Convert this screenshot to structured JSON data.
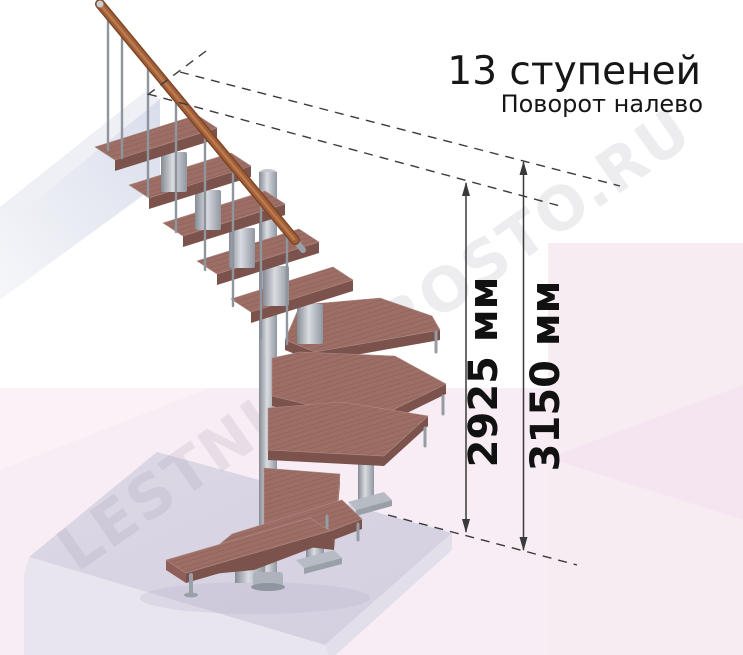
{
  "caption": {
    "title": "13 ступеней",
    "subtitle": "Поворот налево"
  },
  "dimensions": {
    "stair_height": "2925 мм",
    "total_height": "3150 мм"
  },
  "watermark": {
    "text": "LESTNICI-PROSTO.RU"
  },
  "palette": {
    "tread_top": "#9c6e66",
    "tread_front": "#7c524c",
    "tread_side": "#8e5f58",
    "handrail": "#a0603a",
    "handrail_dark": "#7e4526",
    "metal": "#9aa0a8",
    "wall": "#e2e5ef",
    "floor_top": "#d8d4e2",
    "floor_side": "#e9e6f0",
    "background_pink": "#f8ecf3",
    "dimension_line": "#3a3a3a",
    "text": "#161616"
  }
}
